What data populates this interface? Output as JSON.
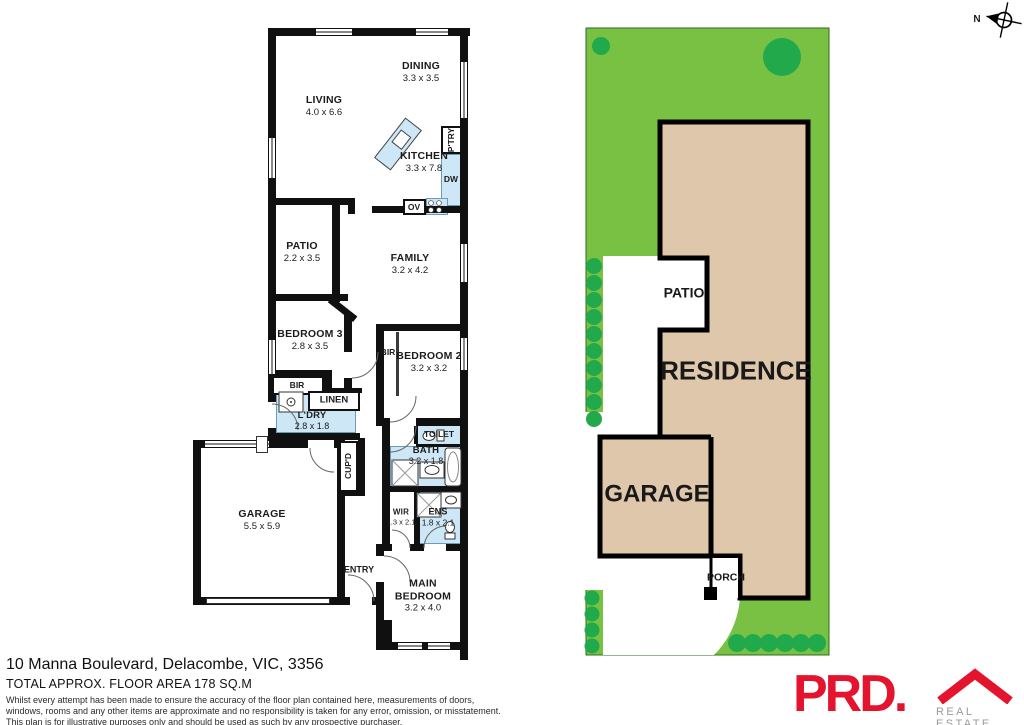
{
  "floorplan": {
    "living": {
      "name": "LIVING",
      "dims": "4.0 x 6.6"
    },
    "dining": {
      "name": "DINING",
      "dims": "3.3 x 3.5"
    },
    "kitchen": {
      "name": "KITCHEN",
      "dims": "3.3 x 7.8"
    },
    "patio": {
      "name": "PATIO",
      "dims": "2.2 x 3.5"
    },
    "family": {
      "name": "FAMILY",
      "dims": "3.2 x 4.2"
    },
    "bedroom3": {
      "name": "BEDROOM 3",
      "dims": "2.8 x 3.5"
    },
    "bedroom2": {
      "name": "BEDROOM 2",
      "dims": "3.2 x 3.2"
    },
    "laundry": {
      "name": "L'DRY",
      "dims": "2.8 x 1.8"
    },
    "bath": {
      "name": "BATH",
      "dims": "3.2 x 1.8"
    },
    "wir": {
      "name": "WIR",
      "dims": "1.3 x 2.1"
    },
    "ens": {
      "name": "ENS",
      "dims": "1.8 x 2.1"
    },
    "garage": {
      "name": "GARAGE",
      "dims": "5.5 x 5.9"
    },
    "main_bedroom": {
      "name": "MAIN BEDROOM",
      "dims": "3.2 x 4.0"
    },
    "pantry": "P'TRY",
    "dishwasher": "DW",
    "oven": "OV",
    "bir_bed3": "BIR",
    "bir_bed2": "BIR",
    "linen": "LINEN",
    "cupboard": "CUP'D",
    "toilet": "TOILET",
    "entry": "ENTRY"
  },
  "site": {
    "residence": "RESIDENCE",
    "garage": "GARAGE",
    "patio": "PATIO",
    "porch": "PORCH"
  },
  "compass": {
    "north": "N"
  },
  "footer": {
    "address": "10 Manna Boulevard, Delacombe, VIC, 3356",
    "area": "TOTAL APPROX. FLOOR AREA 178 SQ.M",
    "disclaimer1": "Whilst every attempt has been made to ensure the accuracy of the floor plan contained here, measurements of doors,",
    "disclaimer2": "windows, rooms and any other items are approximate and no responsibility is taken for any error, omission, or misstatement.",
    "disclaimer3": "This plan is for illustrative purposes only and should be used as such by any prospective purchaser."
  },
  "logo": {
    "brand": "PRD.",
    "tagline": "REAL ESTATE"
  },
  "colors": {
    "lawn": "#79C143",
    "tree": "#21A94C",
    "residence_fill": "#DFC7AC",
    "wet_area": "#CDE7F6",
    "brand_red": "#E4142E"
  }
}
